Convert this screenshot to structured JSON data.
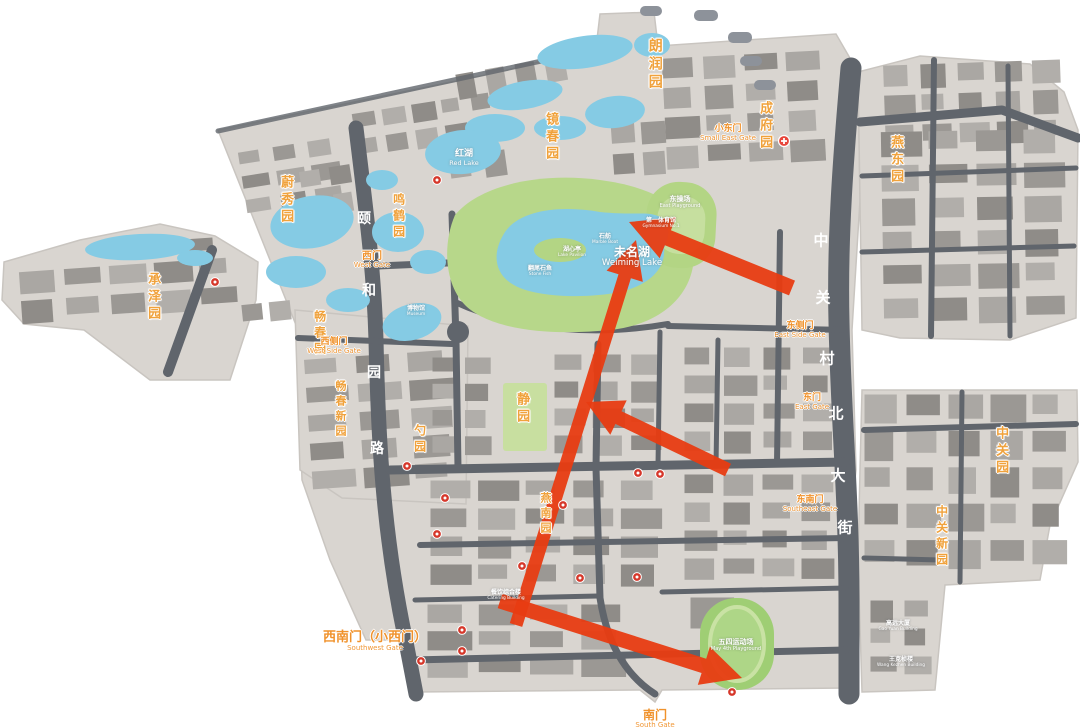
{
  "map": {
    "description": "Peking University campus map with red route arrows",
    "colors": {
      "background": "#ffffff",
      "campus_base": "#d9d5d0",
      "building_dark": "#8f8c88",
      "building_light": "#aaa7a3",
      "road": "#60656c",
      "water": "#85cbe4",
      "green": "#b7d78a",
      "green_light": "#c8dfa0",
      "label_orange": "#f0a23c",
      "gate_orange": "#f0922c",
      "arrow_red": "#e83c12",
      "marker_red": "#d6372a"
    },
    "garden_labels": [
      {
        "text": "朗润园",
        "x": 654,
        "y": 38,
        "vertical": true,
        "size": 14
      },
      {
        "text": "镜春园",
        "x": 550,
        "y": 112,
        "vertical": true,
        "size": 13
      },
      {
        "text": "蔚秀园",
        "x": 285,
        "y": 175,
        "vertical": true,
        "size": 13
      },
      {
        "text": "鸣鹤园",
        "x": 398,
        "y": 193,
        "vertical": true,
        "size": 12
      },
      {
        "text": "承泽园",
        "x": 152,
        "y": 272,
        "vertical": true,
        "size": 13
      },
      {
        "text": "畅春园",
        "x": 319,
        "y": 310,
        "vertical": true,
        "size": 12
      },
      {
        "text": "畅春新园",
        "x": 340,
        "y": 380,
        "vertical": true,
        "size": 11
      },
      {
        "text": "勺园",
        "x": 419,
        "y": 424,
        "vertical": true,
        "size": 12
      },
      {
        "text": "静园",
        "x": 521,
        "y": 392,
        "vertical": true,
        "size": 13
      },
      {
        "text": "燕南园",
        "x": 545,
        "y": 492,
        "vertical": true,
        "size": 11
      },
      {
        "text": "成府园",
        "x": 764,
        "y": 101,
        "vertical": true,
        "size": 13
      },
      {
        "text": "燕东园",
        "x": 895,
        "y": 135,
        "vertical": true,
        "size": 13
      },
      {
        "text": "中关园",
        "x": 1000,
        "y": 426,
        "vertical": true,
        "size": 13
      },
      {
        "text": "中关新园",
        "x": 941,
        "y": 505,
        "vertical": true,
        "size": 12
      }
    ],
    "gate_labels": [
      {
        "text": "西门",
        "en": "West Gate",
        "x": 372,
        "y": 251,
        "size": 10
      },
      {
        "text": "西侧门",
        "en": "West Side Gate",
        "x": 334,
        "y": 338,
        "size": 9
      },
      {
        "text": "小东门",
        "en": "Small East Gate",
        "x": 728,
        "y": 125,
        "size": 9
      },
      {
        "text": "东侧门",
        "en": "East Side Gate",
        "x": 800,
        "y": 322,
        "size": 9
      },
      {
        "text": "东门",
        "en": "East Gate",
        "x": 812,
        "y": 394,
        "size": 9
      },
      {
        "text": "东南门",
        "en": "Southeast Gate",
        "x": 810,
        "y": 496,
        "size": 9
      },
      {
        "text": "西南门（小西门）",
        "en": "Southwest Gate",
        "x": 375,
        "y": 631,
        "size": 13
      },
      {
        "text": "南门",
        "en": "South Gate",
        "x": 655,
        "y": 709,
        "size": 12
      }
    ],
    "road_name_yiheyuan": {
      "name": "颐和园路",
      "chars": [
        {
          "text": "颐",
          "x": 364,
          "y": 218
        },
        {
          "text": "和",
          "x": 369,
          "y": 290
        },
        {
          "text": "园",
          "x": 374,
          "y": 372
        },
        {
          "text": "路",
          "x": 377,
          "y": 448
        }
      ],
      "size": 14
    },
    "road_name_zhongguancun": {
      "name": "中关村北大街",
      "chars": [
        {
          "text": "中",
          "x": 821,
          "y": 240
        },
        {
          "text": "关",
          "x": 823,
          "y": 297
        },
        {
          "text": "村",
          "x": 827,
          "y": 358
        },
        {
          "text": "北",
          "x": 836,
          "y": 413
        },
        {
          "text": "大",
          "x": 838,
          "y": 475
        },
        {
          "text": "街",
          "x": 845,
          "y": 527
        }
      ],
      "size": 15
    },
    "area_labels": [
      {
        "text": "未名湖",
        "en": "Weiming Lake",
        "x": 632,
        "y": 246,
        "size": 12
      },
      {
        "text": "红湖",
        "en": "Red Lake",
        "x": 464,
        "y": 150,
        "size": 9
      },
      {
        "text": "石舫",
        "en": "Marble Boat",
        "x": 605,
        "y": 234,
        "size": 6
      },
      {
        "text": "湖心亭",
        "en": "Lake Pavilion",
        "x": 572,
        "y": 247,
        "size": 6
      },
      {
        "text": "翻尾石鱼",
        "en": "Stone Fish",
        "x": 540,
        "y": 266,
        "size": 6
      },
      {
        "text": "东操场",
        "en": "East Playground",
        "x": 680,
        "y": 196,
        "size": 7
      },
      {
        "text": "第一体育馆",
        "en": "Gymnasium No.1",
        "x": 661,
        "y": 218,
        "size": 6
      },
      {
        "text": "五四运动场",
        "en": "May 4th Playground",
        "x": 736,
        "y": 639,
        "size": 7
      },
      {
        "text": "博物馆",
        "en": "Museum",
        "x": 416,
        "y": 306,
        "size": 6
      },
      {
        "text": "餐饮综合楼",
        "en": "Catering Building",
        "x": 506,
        "y": 590,
        "size": 6
      },
      {
        "text": "高远大厦",
        "en": "Gao Yuan Building",
        "x": 898,
        "y": 621,
        "size": 6
      },
      {
        "text": "王克桢楼",
        "en": "Wang Kezhen Building",
        "x": 901,
        "y": 657,
        "size": 6
      }
    ],
    "arrows": [
      {
        "name": "route-arrow-south-to-lake",
        "x1": 516,
        "y1": 625,
        "x2": 636,
        "y2": 240,
        "w": 6.5,
        "hl": 38,
        "hw": 19
      },
      {
        "name": "route-arrow-east-to-lake",
        "x1": 792,
        "y1": 288,
        "x2": 629,
        "y2": 222,
        "w": 8,
        "hl": 42,
        "hw": 22
      },
      {
        "name": "route-arrow-to-jingyuan",
        "x1": 728,
        "y1": 470,
        "x2": 586,
        "y2": 402,
        "w": 7,
        "hl": 36,
        "hw": 19
      },
      {
        "name": "route-arrow-to-stadium",
        "x1": 500,
        "y1": 601,
        "x2": 742,
        "y2": 678,
        "w": 7.5,
        "hl": 40,
        "hw": 20
      }
    ],
    "markers": [
      {
        "x": 215,
        "y": 282
      },
      {
        "x": 437,
        "y": 180
      },
      {
        "x": 407,
        "y": 466
      },
      {
        "x": 445,
        "y": 498
      },
      {
        "x": 437,
        "y": 534
      },
      {
        "x": 563,
        "y": 505
      },
      {
        "x": 522,
        "y": 566
      },
      {
        "x": 580,
        "y": 578
      },
      {
        "x": 637,
        "y": 577
      },
      {
        "x": 660,
        "y": 474
      },
      {
        "x": 638,
        "y": 473
      },
      {
        "x": 462,
        "y": 630
      },
      {
        "x": 462,
        "y": 651
      },
      {
        "x": 421,
        "y": 661
      },
      {
        "x": 732,
        "y": 692
      }
    ],
    "hospital_marker": {
      "x": 784,
      "y": 141
    }
  }
}
